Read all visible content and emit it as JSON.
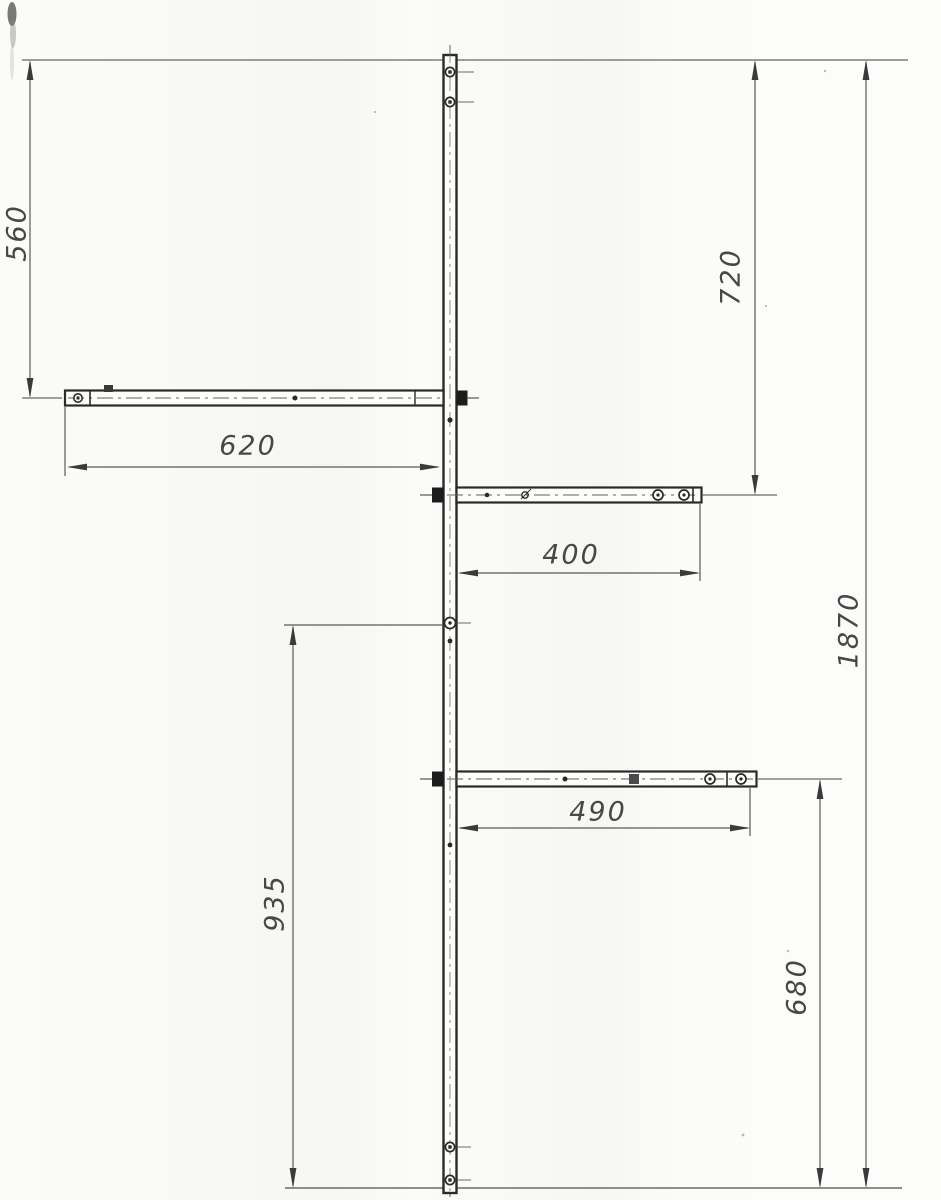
{
  "document": {
    "kind": "scanned technical drawing",
    "subject": "Vertical mast with one left arm and two right arms, front view with linear dimensions",
    "paper_color": "#fbfbf8",
    "ink_color": "#2a2a2a",
    "thin_line_color": "#5a5a5a"
  },
  "parts": {
    "mast": {
      "name": "vertical mast"
    },
    "left_arm": {
      "name": "left horizontal arm"
    },
    "upper_right_arm": {
      "name": "upper right horizontal arm"
    },
    "lower_right_arm": {
      "name": "lower right horizontal arm"
    }
  },
  "dims": {
    "d560": {
      "value": "560",
      "orientation": "vertical",
      "measures": "top line to left arm axis"
    },
    "d720": {
      "value": "720",
      "orientation": "vertical",
      "measures": "top line to upper right arm axis"
    },
    "d620": {
      "value": "620",
      "orientation": "horizontal",
      "measures": "left arm end to mast"
    },
    "d400": {
      "value": "400",
      "orientation": "horizontal",
      "measures": "mast to upper right arm end"
    },
    "d1870": {
      "value": "1870",
      "orientation": "vertical",
      "measures": "overall mast height"
    },
    "d935": {
      "value": "935",
      "orientation": "vertical",
      "measures": "mid mast hole to bottom line"
    },
    "d490": {
      "value": "490",
      "orientation": "horizontal",
      "measures": "mast to lower right arm end"
    },
    "d680": {
      "value": "680",
      "orientation": "vertical",
      "measures": "lower right arm axis to bottom line"
    }
  }
}
